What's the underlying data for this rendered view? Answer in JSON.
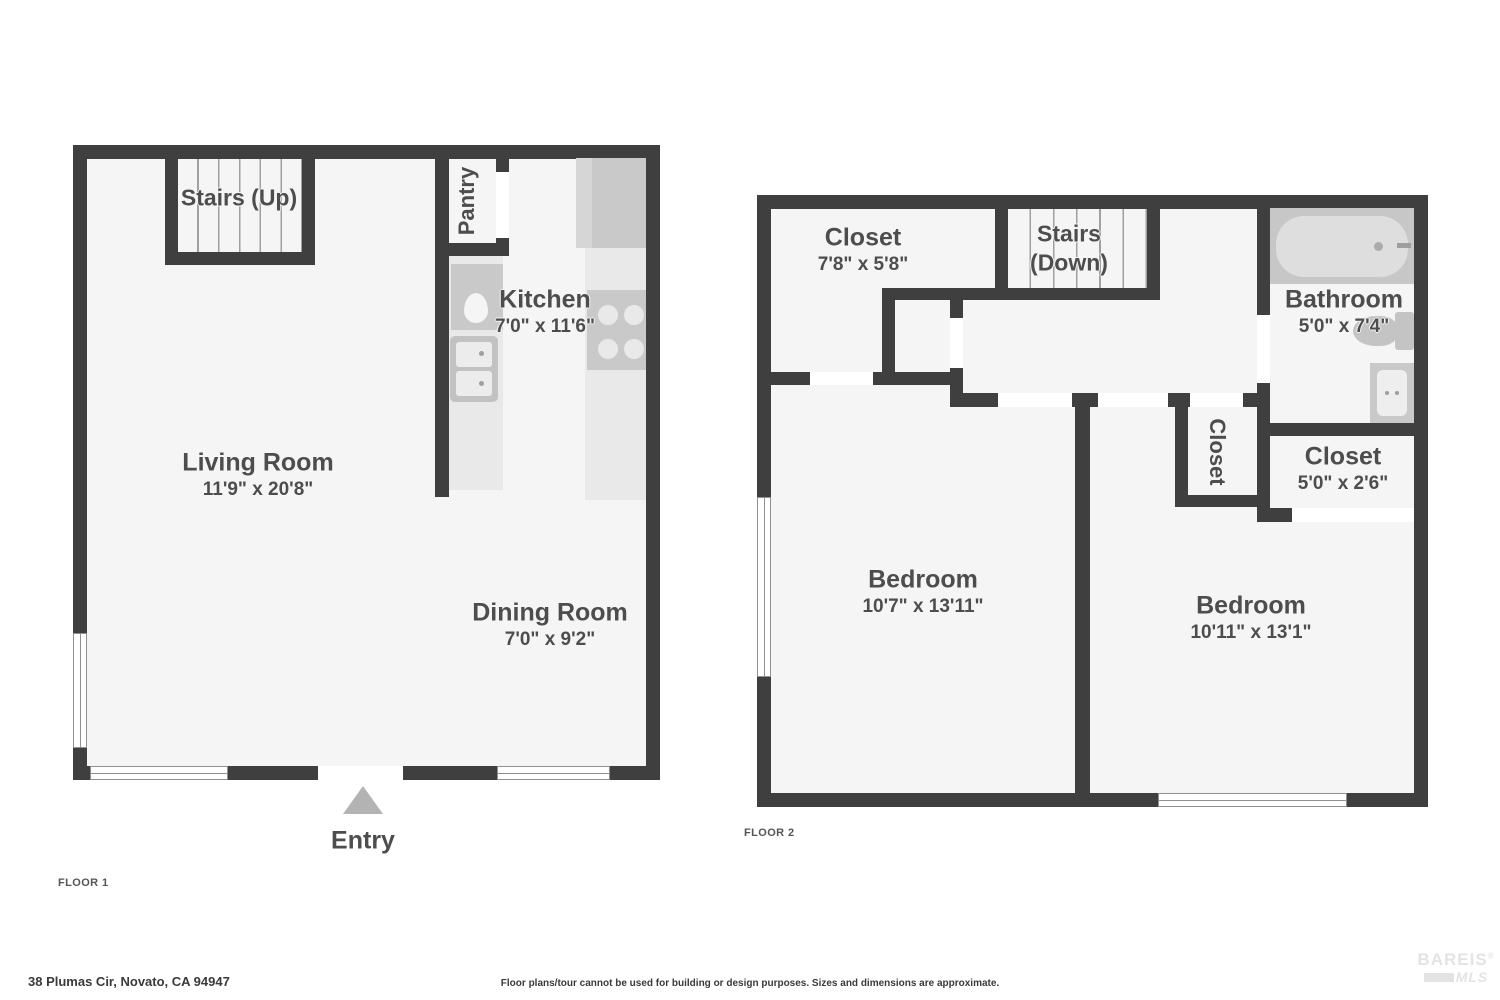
{
  "floor1": {
    "tag": "FLOOR 1",
    "stairs_label": "Stairs (Up)",
    "pantry_label": "Pantry",
    "kitchen": {
      "name": "Kitchen",
      "dims": "7'0\" x 11'6\""
    },
    "living": {
      "name": "Living Room",
      "dims": "11'9\" x 20'8\""
    },
    "dining": {
      "name": "Dining Room",
      "dims": "7'0\" x 9'2\""
    },
    "entry_label": "Entry"
  },
  "floor2": {
    "tag": "FLOOR 2",
    "closet_top": {
      "name": "Closet",
      "dims": "7'8\" x 5'8\""
    },
    "stairs_line1": "Stairs",
    "stairs_line2": "(Down)",
    "bathroom": {
      "name": "Bathroom",
      "dims": "5'0\" x 7'4\""
    },
    "closet_mid_label": "Closet",
    "closet_right": {
      "name": "Closet",
      "dims": "5'0\" x 2'6\""
    },
    "bedroom1": {
      "name": "Bedroom",
      "dims": "10'7\" x 13'11\""
    },
    "bedroom2": {
      "name": "Bedroom",
      "dims": "10'11\" x 13'1\""
    }
  },
  "footer": {
    "address": "38 Plumas Cir, Novato, CA 94947",
    "disclaimer": "Floor plans/tour cannot be used for building or design purposes. Sizes and dimensions are approximate.",
    "logo": {
      "line1": "BAREIS",
      "registered": "®",
      "line2": "MLS"
    }
  },
  "colors": {
    "wall": "#3f3f3f",
    "floor": "#f5f5f5",
    "fixture_gray": "#c9c9c9",
    "counter_gray": "#e9e9e9",
    "entry_triangle": "#b3b3b3",
    "label_text": "#4d4d4d",
    "logo_gray": "#e3e3e3"
  }
}
